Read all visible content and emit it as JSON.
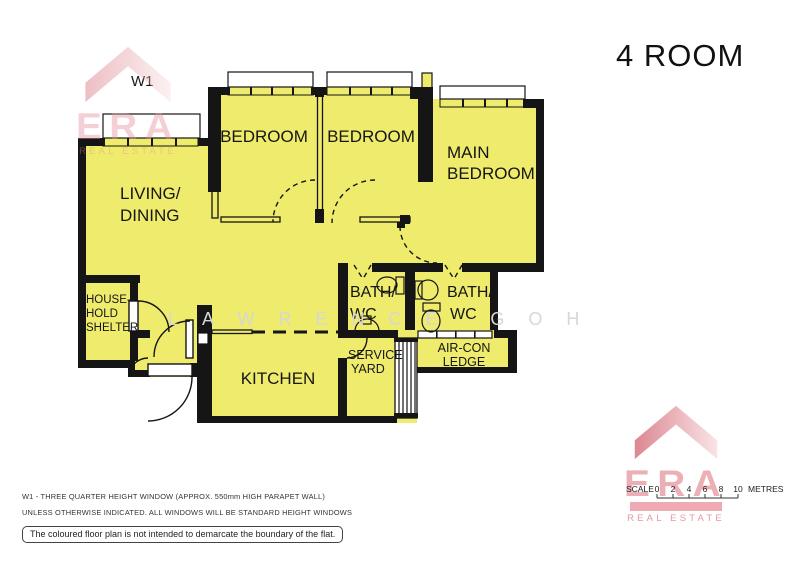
{
  "title": "4 ROOM",
  "plan": {
    "window_label": "W1",
    "rooms": {
      "living_line1": "LIVING/",
      "living_line2": "DINING",
      "bedroom1": "BEDROOM",
      "bedroom2": "BEDROOM",
      "main_line1": "MAIN",
      "main_line2": "BEDROOM",
      "bath_left_line1": "BATH/",
      "bath_left_line2": "WC",
      "bath_right_line1": "BATH/",
      "bath_right_line2": "WC",
      "kitchen": "KITCHEN",
      "service_line1": "SERVICE",
      "service_line2": "YARD",
      "aircon_line1": "AIR-CON",
      "aircon_line2": "LEDGE",
      "shelter_line1": "HOUSE-",
      "shelter_line2": "HOLD",
      "shelter_line3": "SHELTER"
    }
  },
  "brand": {
    "name": "ERA",
    "subtitle": "REAL ESTATE"
  },
  "watermark_name": "LAWRENCE GOH",
  "scale_bar": {
    "label": "SCALE",
    "ticks": [
      "0",
      "2",
      "4",
      "6",
      "8",
      "10"
    ],
    "unit": "METRES"
  },
  "notes": {
    "note1": "W1  -  THREE QUARTER HEIGHT WINDOW (APPROX. 550mm HIGH PARAPET WALL)",
    "note2": "UNLESS OTHERWISE INDICATED.  ALL WINDOWS WILL BE STANDARD HEIGHT WINDOWS",
    "disclaimer": "The coloured floor plan is not intended to demarcate the boundary of the flat."
  },
  "colors": {
    "room_fill": "#EEEB6D",
    "wall": "#151515",
    "brand_red": "#CE5A68",
    "brand_pink": "#F8DADD"
  }
}
